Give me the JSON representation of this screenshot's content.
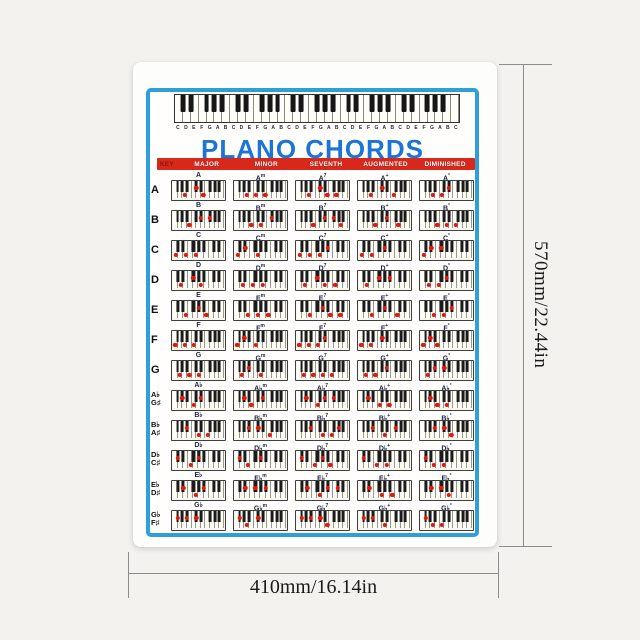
{
  "scene": {
    "background": "#f3f2ef",
    "dimension_height_label": "570mm/22.44in",
    "dimension_width_label": "410mm/16.14in"
  },
  "poster": {
    "title": "PLANO CHORDS",
    "keyboard_letters": "CDEFGABCDEFGABCDEFGABCDEFGABCDEFGABC",
    "column_headers": [
      "KEY",
      "MAJOR",
      "MINOR",
      "SEVENTH",
      "AUGMENTED",
      "DIMINISHED"
    ],
    "chord_suffixes": [
      "",
      "m",
      "7",
      "+",
      "°"
    ],
    "rows": [
      {
        "key_labels": [
          "A"
        ],
        "root": "A"
      },
      {
        "key_labels": [
          "B"
        ],
        "root": "B"
      },
      {
        "key_labels": [
          "C"
        ],
        "root": "C"
      },
      {
        "key_labels": [
          "D"
        ],
        "root": "D"
      },
      {
        "key_labels": [
          "E"
        ],
        "root": "E"
      },
      {
        "key_labels": [
          "F"
        ],
        "root": "F"
      },
      {
        "key_labels": [
          "G"
        ],
        "root": "G"
      },
      {
        "key_labels": [
          "A♭",
          "G♯"
        ],
        "root": "A♭"
      },
      {
        "key_labels": [
          "B♭",
          "A♯"
        ],
        "root": "B♭"
      },
      {
        "key_labels": [
          "D♭",
          "C♯"
        ],
        "root": "D♭"
      },
      {
        "key_labels": [
          "E♭",
          "D♯"
        ],
        "root": "E♭"
      },
      {
        "key_labels": [
          "G♭",
          "F♯"
        ],
        "root": "G♭"
      }
    ],
    "colors": {
      "frame_blue": "#2f9fda",
      "title_blue": "#1b74d6",
      "header_red": "#d8281c",
      "dot_red": "#e8150c"
    }
  },
  "music": {
    "note_semitones": {
      "C": 0,
      "C♯": 1,
      "D♭": 1,
      "D": 2,
      "D♯": 3,
      "E♭": 3,
      "E": 4,
      "F": 5,
      "F♯": 6,
      "G♭": 6,
      "G": 7,
      "G♯": 8,
      "A♭": 8,
      "A": 9,
      "A♯": 10,
      "B♭": 10,
      "B": 11
    },
    "chord_type_intervals": [
      [
        0,
        4,
        7
      ],
      [
        0,
        3,
        7
      ],
      [
        0,
        4,
        7,
        10
      ],
      [
        0,
        4,
        8
      ],
      [
        0,
        3,
        6
      ]
    ]
  }
}
